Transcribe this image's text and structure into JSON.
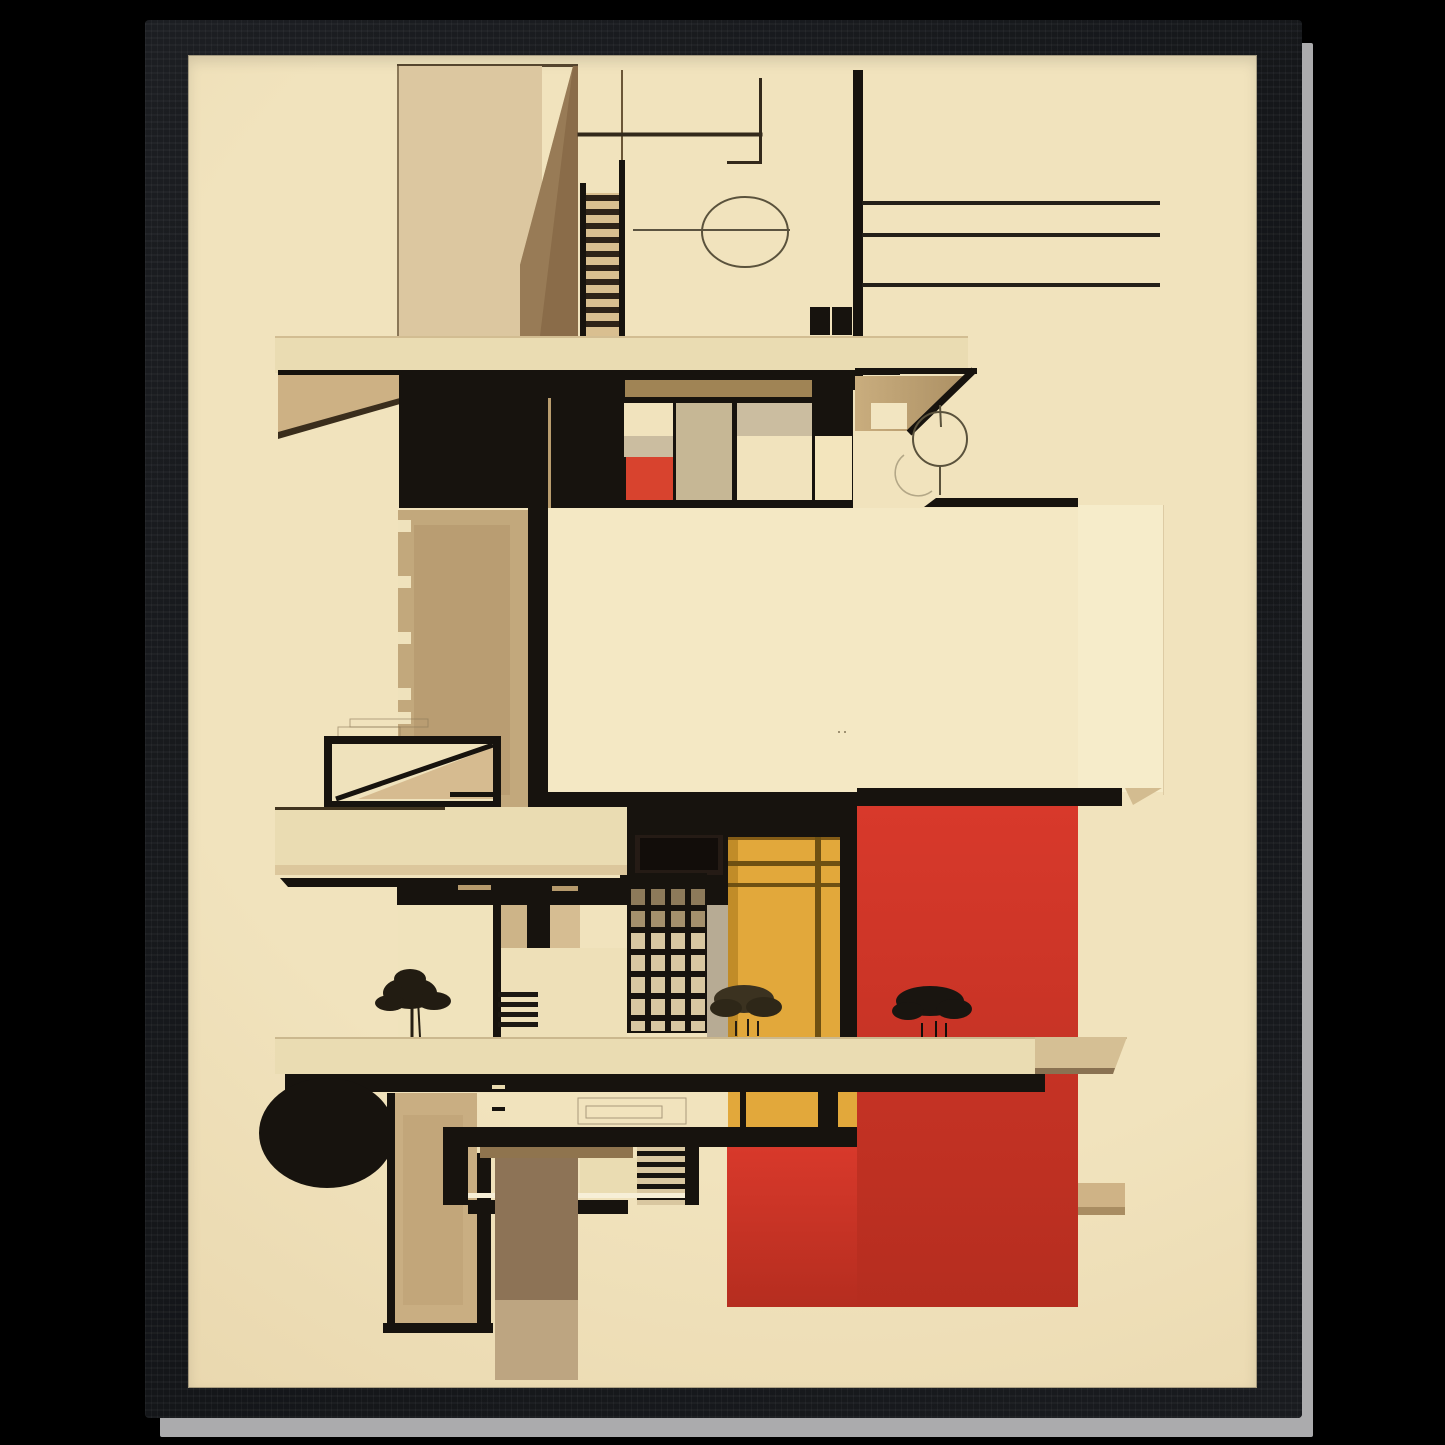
{
  "artwork": {
    "title": "Bauhaus Abstract Architecture Poster",
    "style": "constructivist framed art print, no visible text",
    "frame": {
      "material": "black wood frame",
      "edge_highlight": "light gray outer edge on right and bottom"
    },
    "motifs": [
      "staircase ladder",
      "ellipse doodle",
      "window band with red pane",
      "large cream facade panel",
      "big red block",
      "yellow door block",
      "grid window",
      "three plant silhouettes",
      "black circle",
      "balcony slabs",
      "bench structure"
    ],
    "palette": {
      "page_bg": "#000000",
      "edge": "#ababad",
      "cream_bg": "#f1e3bd",
      "cream_bg_dark": "#e7d4aa",
      "panel": "#f4e8c4",
      "panel_light": "#f6ecca",
      "slab": "#eadcb2",
      "beige_wall": "#dcc7a0",
      "tan": "#c2a87c",
      "brown": "#8a6c49",
      "brown_header": "#a08455",
      "ink": "#17130e",
      "red_big": "#d8392b",
      "red_big_dark": "#b52d1f",
      "red_small": "#d8432e",
      "yellow": "#e2a83b",
      "yellow_dark": "#c18c28",
      "yellow_line": "#6e5012",
      "gray_pane": "#cbbda0",
      "gray_strip": "#b7ab94",
      "grid_cell": "#d8c7a1",
      "grid_cell_dark": "#8d7a5a",
      "plant_dark": "#191510",
      "plant_olive": "#3b3220",
      "line_thin": "#33291b",
      "doodle": "#5a523c"
    }
  }
}
